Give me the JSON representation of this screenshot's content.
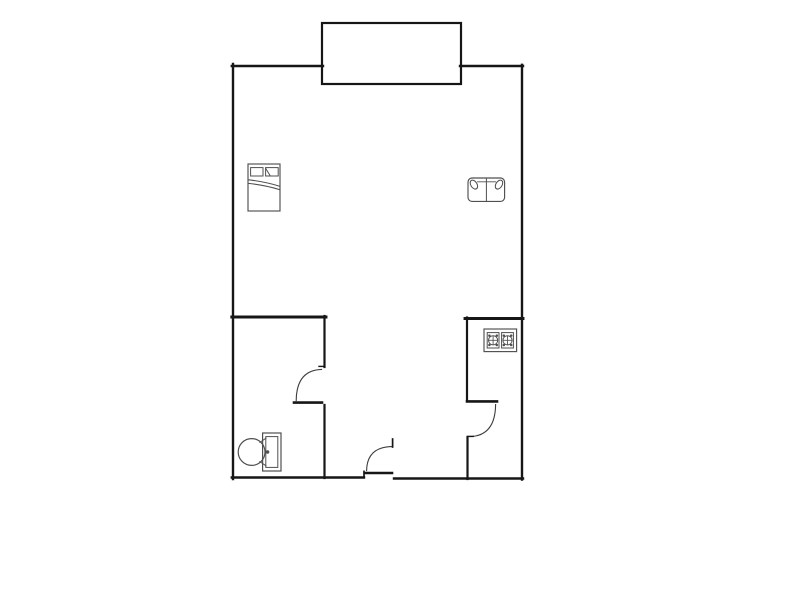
{
  "figure": {
    "kind": "floor-plan",
    "has_text": false
  },
  "canvas": {
    "width": 800,
    "height": 600
  },
  "colors": {
    "background": "#ffffff",
    "wall": "#161616",
    "door": "#3c3c3c",
    "furniture": "#4f4f4f"
  },
  "shapes": [
    {
      "g": "walls",
      "name": "left-wall",
      "type": "line",
      "x1": 233,
      "y1": 64,
      "x2": 233,
      "y2": 479,
      "sw": 2.4
    },
    {
      "g": "walls",
      "name": "top-wall-left",
      "type": "line",
      "x1": 231.8,
      "y1": 66,
      "x2": 323,
      "y2": 66,
      "sw": 2.4
    },
    {
      "g": "walls",
      "name": "top-wall-right",
      "type": "line",
      "x1": 460,
      "y1": 66,
      "x2": 523,
      "y2": 66,
      "sw": 2.4
    },
    {
      "g": "walls",
      "name": "right-wall",
      "type": "line",
      "x1": 522,
      "y1": 64.8,
      "x2": 522,
      "y2": 479.5,
      "sw": 2.4
    },
    {
      "g": "walls",
      "name": "bottom-wall-left",
      "type": "line",
      "x1": 231.8,
      "y1": 477.5,
      "x2": 364,
      "y2": 477.5,
      "sw": 2.4
    },
    {
      "g": "walls",
      "name": "bottom-wall-right",
      "type": "line",
      "x1": 394,
      "y1": 478.5,
      "x2": 523,
      "y2": 478.5,
      "sw": 2.4
    },
    {
      "g": "walls",
      "name": "bathroom-top-wall",
      "type": "line",
      "x1": 231.8,
      "y1": 317,
      "x2": 326,
      "y2": 317,
      "sw": 2.9
    },
    {
      "g": "walls",
      "name": "bathroom-east-wall-upper",
      "type": "line",
      "x1": 324.5,
      "y1": 316,
      "x2": 324.5,
      "y2": 367,
      "sw": 2.2
    },
    {
      "g": "walls",
      "name": "bathroom-east-wall-lower",
      "type": "line",
      "x1": 324.5,
      "y1": 405,
      "x2": 324.5,
      "y2": 478,
      "sw": 2.2
    },
    {
      "g": "walls",
      "name": "kitchen-top-wall",
      "type": "line",
      "x1": 465,
      "y1": 318.5,
      "x2": 523,
      "y2": 318.5,
      "sw": 2.9
    },
    {
      "g": "walls",
      "name": "kitchen-west-wall-upper",
      "type": "line",
      "x1": 467,
      "y1": 317.5,
      "x2": 467,
      "y2": 400,
      "sw": 2.2
    },
    {
      "g": "walls",
      "name": "kitchen-west-wall-lower",
      "type": "line",
      "x1": 467.5,
      "y1": 437,
      "x2": 467.5,
      "y2": 479,
      "sw": 2.2
    },
    {
      "g": "balcony",
      "name": "balcony-outline",
      "type": "rect",
      "x": 322,
      "y": 23,
      "width": 139,
      "height": 61,
      "sw": 2.2
    },
    {
      "g": "bathroom-door",
      "name": "bathroom-door-leaf",
      "type": "line",
      "x1": 294,
      "y1": 402.6,
      "x2": 322,
      "y2": 402.6,
      "sw": 2.6
    },
    {
      "g": "bathroom-door",
      "name": "bathroom-door-arc",
      "type": "path",
      "d": "M 296.2 400.6 Q 296.4 370.2 321.6 369.4",
      "sw": 1.1,
      "stroke": "door"
    },
    {
      "g": "bathroom-door",
      "name": "bathroom-door-jamb-tick",
      "type": "line",
      "x1": 319,
      "y1": 366.4,
      "x2": 324.8,
      "y2": 366.4,
      "sw": 1.4
    },
    {
      "g": "kitchen-door",
      "name": "kitchen-door-leaf",
      "type": "line",
      "x1": 467,
      "y1": 401.4,
      "x2": 497,
      "y2": 401.4,
      "sw": 2.6
    },
    {
      "g": "kitchen-door",
      "name": "kitchen-door-arc",
      "type": "path",
      "d": "M 495.6 404.6 Q 495.2 435.6 470.2 436.6",
      "sw": 1.1,
      "stroke": "door"
    },
    {
      "g": "kitchen-door",
      "name": "kitchen-door-jamb-tick",
      "type": "line",
      "x1": 467.6,
      "y1": 436.4,
      "x2": 473.2,
      "y2": 436.4,
      "sw": 1.4
    },
    {
      "g": "entry-door",
      "name": "entry-door-leaf",
      "type": "line",
      "x1": 365.6,
      "y1": 473,
      "x2": 392,
      "y2": 473,
      "sw": 2.6
    },
    {
      "g": "entry-door",
      "name": "entry-door-arc",
      "type": "path",
      "d": "M 392 446.6 Q 367 447 366.6 470.6",
      "sw": 1.1,
      "stroke": "door"
    },
    {
      "g": "entry-door",
      "name": "entry-door-jamb-tick",
      "type": "line",
      "x1": 364,
      "y1": 471.4,
      "x2": 364,
      "y2": 477,
      "sw": 1.7
    },
    {
      "g": "entry-door",
      "name": "entry-door-tip-tick",
      "type": "line",
      "x1": 392.6,
      "y1": 439,
      "x2": 392.6,
      "y2": 447,
      "sw": 1.7
    },
    {
      "g": "bed-icon",
      "name": "bed-frame",
      "type": "rect",
      "x": 248,
      "y": 164,
      "width": 32,
      "height": 47,
      "sw": 1.15,
      "stroke": "furniture"
    },
    {
      "g": "bed-icon",
      "name": "bed-pillow-left",
      "type": "rect",
      "x": 250.6,
      "y": 167.6,
      "width": 12.4,
      "height": 8.4,
      "sw": 1,
      "stroke": "furniture"
    },
    {
      "g": "bed-icon",
      "name": "bed-pillow-right",
      "type": "rect",
      "x": 265.6,
      "y": 167.6,
      "width": 12.6,
      "height": 8.4,
      "sw": 1,
      "stroke": "furniture"
    },
    {
      "g": "bed-icon",
      "name": "bed-pillow-fold",
      "type": "line",
      "x1": 265.6,
      "y1": 168.2,
      "x2": 270.2,
      "y2": 175.8,
      "sw": 1,
      "stroke": "furniture"
    },
    {
      "g": "bed-icon",
      "name": "bed-blanket-line-1",
      "type": "path",
      "d": "M 248.4 179.8 C 259 181 271 183.6 279.6 186.2",
      "sw": 1.05,
      "stroke": "furniture"
    },
    {
      "g": "bed-icon",
      "name": "bed-blanket-line-2",
      "type": "path",
      "d": "M 248.4 183.4 C 259 184.4 271 187 279.6 189.6",
      "sw": 1.05,
      "stroke": "furniture"
    },
    {
      "g": "sofa-icon",
      "name": "sofa-body",
      "type": "rect",
      "x": 468,
      "y": 178,
      "width": 36.6,
      "height": 23.4,
      "rx": 4,
      "sw": 1.15,
      "stroke": "furniture"
    },
    {
      "g": "sofa-icon",
      "name": "sofa-divider",
      "type": "line",
      "x1": 486.4,
      "y1": 178.8,
      "x2": 486.4,
      "y2": 201,
      "sw": 1,
      "stroke": "furniture"
    },
    {
      "g": "sofa-icon",
      "name": "sofa-back-line",
      "type": "line",
      "x1": 477.6,
      "y1": 181.8,
      "x2": 495.6,
      "y2": 181.8,
      "sw": 0.95,
      "stroke": "furniture"
    },
    {
      "g": "sofa-icon",
      "name": "sofa-armrest-left",
      "type": "ellipse",
      "cx": 473.9,
      "cy": 184.6,
      "rx": 3.1,
      "ry": 4.9,
      "rot": -32,
      "sw": 1.05,
      "stroke": "furniture"
    },
    {
      "g": "sofa-icon",
      "name": "sofa-armrest-right",
      "type": "ellipse",
      "cx": 499,
      "cy": 184.6,
      "rx": 3.1,
      "ry": 4.9,
      "rot": 32,
      "sw": 1.05,
      "stroke": "furniture"
    },
    {
      "g": "stove-icon",
      "name": "stove-outline",
      "type": "rect",
      "x": 484,
      "y": 329,
      "width": 32.6,
      "height": 22.6,
      "sw": 1.15,
      "stroke": "furniture"
    },
    {
      "g": "stove-icon",
      "name": "stove-burner-left-square",
      "type": "rect",
      "x": 487.2,
      "y": 332.6,
      "width": 11.8,
      "height": 15.4,
      "sw": 1,
      "stroke": "furniture"
    },
    {
      "g": "stove-icon",
      "name": "stove-burner-right-square",
      "type": "rect",
      "x": 501.6,
      "y": 332.6,
      "width": 11.8,
      "height": 15.4,
      "sw": 1,
      "stroke": "furniture"
    },
    {
      "g": "stove-icon",
      "name": "stove-burner-left-ring",
      "type": "circle",
      "cx": 493.1,
      "cy": 340.3,
      "r": 4.6,
      "sw": 1,
      "stroke": "furniture"
    },
    {
      "g": "stove-icon",
      "name": "stove-burner-right-ring",
      "type": "circle",
      "cx": 507.5,
      "cy": 340.3,
      "r": 4.6,
      "sw": 1,
      "stroke": "furniture"
    },
    {
      "g": "stove-icon",
      "name": "stove-burner-left-cross-h",
      "type": "line",
      "x1": 488.7,
      "y1": 340.3,
      "x2": 497.5,
      "y2": 340.3,
      "sw": 0.85,
      "stroke": "furniture"
    },
    {
      "g": "stove-icon",
      "name": "stove-burner-left-cross-v",
      "type": "line",
      "x1": 493.1,
      "y1": 335.9,
      "x2": 493.1,
      "y2": 344.7,
      "sw": 0.85,
      "stroke": "furniture"
    },
    {
      "g": "stove-icon",
      "name": "stove-burner-right-cross-h",
      "type": "line",
      "x1": 503.1,
      "y1": 340.3,
      "x2": 511.9,
      "y2": 340.3,
      "sw": 0.85,
      "stroke": "furniture"
    },
    {
      "g": "stove-icon",
      "name": "stove-burner-right-cross-v",
      "type": "line",
      "x1": 507.5,
      "y1": 335.9,
      "x2": 507.5,
      "y2": 344.7,
      "sw": 0.85,
      "stroke": "furniture"
    },
    {
      "g": "stove-icon",
      "name": "stove-burner-left-dot-1",
      "type": "circle",
      "cx": 489.4,
      "cy": 335.6,
      "r": 1.25,
      "sw": 0,
      "fill": "furniture"
    },
    {
      "g": "stove-icon",
      "name": "stove-burner-left-dot-2",
      "type": "circle",
      "cx": 496.8,
      "cy": 335.6,
      "r": 1.25,
      "sw": 0,
      "fill": "furniture"
    },
    {
      "g": "stove-icon",
      "name": "stove-burner-left-dot-3",
      "type": "circle",
      "cx": 489.4,
      "cy": 345,
      "r": 1.25,
      "sw": 0,
      "fill": "furniture"
    },
    {
      "g": "stove-icon",
      "name": "stove-burner-left-dot-4",
      "type": "circle",
      "cx": 496.8,
      "cy": 345,
      "r": 1.25,
      "sw": 0,
      "fill": "furniture"
    },
    {
      "g": "stove-icon",
      "name": "stove-burner-right-dot-1",
      "type": "circle",
      "cx": 503.8,
      "cy": 335.6,
      "r": 1.25,
      "sw": 0,
      "fill": "furniture"
    },
    {
      "g": "stove-icon",
      "name": "stove-burner-right-dot-2",
      "type": "circle",
      "cx": 511.2,
      "cy": 335.6,
      "r": 1.25,
      "sw": 0,
      "fill": "furniture"
    },
    {
      "g": "stove-icon",
      "name": "stove-burner-right-dot-3",
      "type": "circle",
      "cx": 503.8,
      "cy": 345,
      "r": 1.25,
      "sw": 0,
      "fill": "furniture"
    },
    {
      "g": "stove-icon",
      "name": "stove-burner-right-dot-4",
      "type": "circle",
      "cx": 511.2,
      "cy": 345,
      "r": 1.25,
      "sw": 0,
      "fill": "furniture"
    },
    {
      "g": "toilet-icon",
      "name": "toilet-tank",
      "type": "rect",
      "x": 262.6,
      "y": 433,
      "width": 18.4,
      "height": 38,
      "sw": 1.2,
      "stroke": "furniture"
    },
    {
      "g": "toilet-icon",
      "name": "toilet-tank-inner",
      "type": "rect",
      "x": 265.8,
      "y": 436.6,
      "width": 12,
      "height": 30.8,
      "sw": 1,
      "stroke": "furniture"
    },
    {
      "g": "toilet-icon",
      "name": "toilet-bowl",
      "type": "circle",
      "cx": 251.6,
      "cy": 452,
      "r": 13.4,
      "sw": 1.2,
      "stroke": "furniture"
    },
    {
      "g": "toilet-icon",
      "name": "toilet-flush-button",
      "type": "circle",
      "cx": 267.6,
      "cy": 452,
      "r": 1.7,
      "sw": 0,
      "fill": "furniture"
    },
    {
      "g": "toilet-icon",
      "name": "toilet-seat-link-top",
      "type": "line",
      "x1": 259.8,
      "y1": 442.4,
      "x2": 266,
      "y2": 438.2,
      "sw": 0.95,
      "stroke": "furniture"
    },
    {
      "g": "toilet-icon",
      "name": "toilet-seat-link-bottom",
      "type": "line",
      "x1": 259.8,
      "y1": 461.6,
      "x2": 266,
      "y2": 465.8,
      "sw": 0.95,
      "stroke": "furniture"
    }
  ]
}
